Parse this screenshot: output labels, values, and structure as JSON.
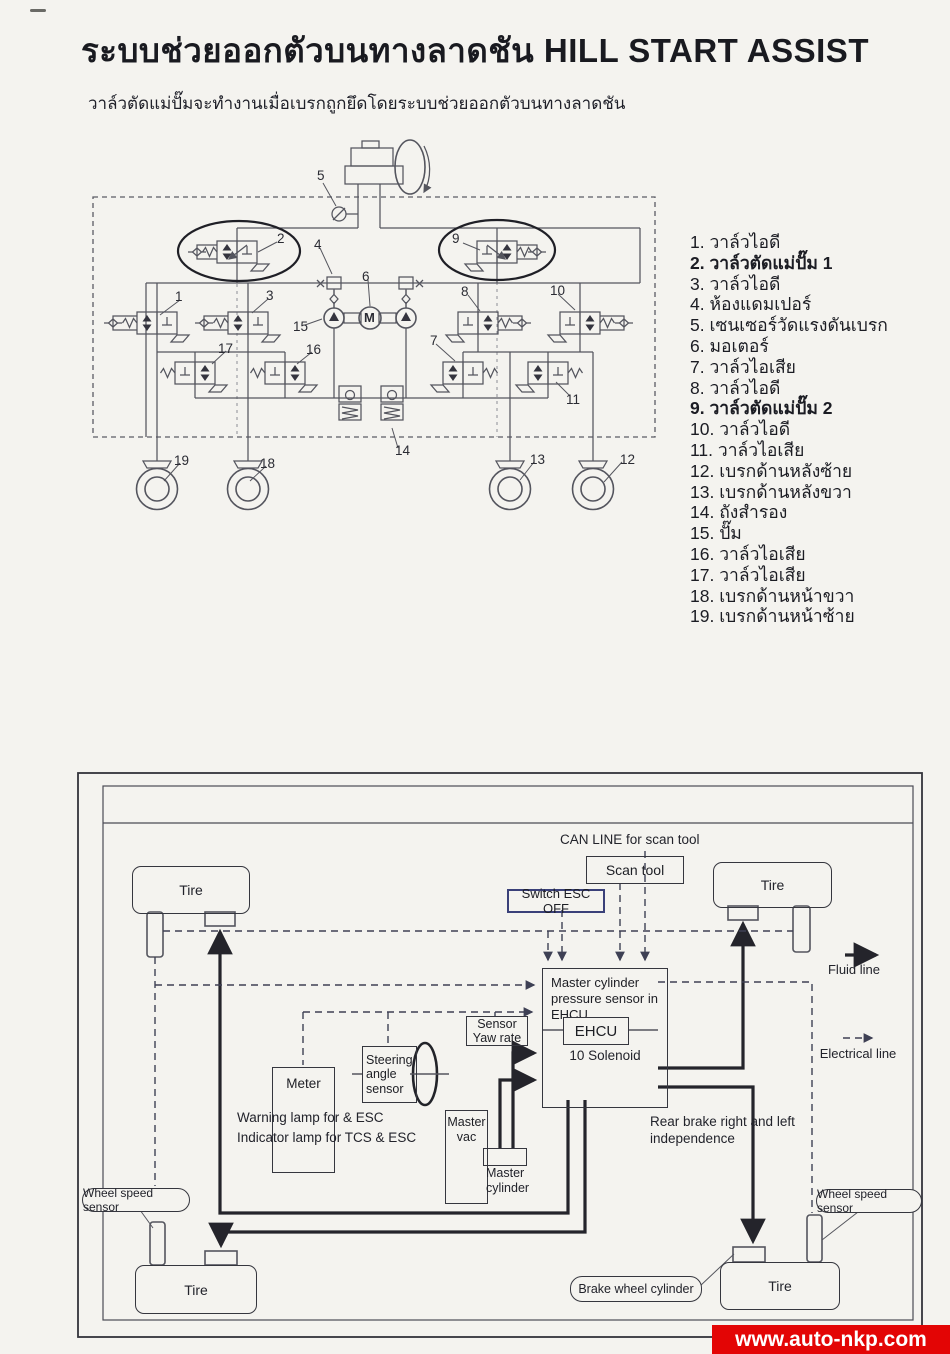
{
  "page": {
    "title": "ระบบช่วยออกตัวบนทางลาดชัน HILL START ASSIST",
    "subtitle": "วาล์วตัดแม่ปั๊มจะทำงานเมื่อเบรกถูกยึดโดยระบบช่วยออกตัวบนทางลาดชัน"
  },
  "legend": {
    "items": [
      "1. วาล์วไอดี",
      "2. วาล์วตัดแม่ปั๊ม 1",
      "3. วาล์วไอดี",
      "4. ห้องแดมเปอร์",
      "5. เซนเซอร์วัดแรงดันเบรก",
      "6. มอเตอร์",
      "7. วาล์วไอเสีย",
      "8. วาล์วไอดี",
      "9. วาล์วตัดแม่ปั๊ม 2",
      "10. วาล์วไอดี",
      "11. วาล์วไอเสีย",
      "12. เบรกด้านหลังซ้าย",
      "13. เบรกด้านหลังขวา",
      "14. ถังสำรอง",
      "15. ปั๊ม",
      "16. วาล์วไอเสีย",
      "17. วาล์วไอเสีย",
      "18. เบรกด้านหน้าขวา",
      "19. เบรกด้านหน้าซ้าย"
    ]
  },
  "top_diagram": {
    "motor_label": "M",
    "callouts": [
      "1",
      "2",
      "3",
      "4",
      "5",
      "6",
      "7",
      "8",
      "9",
      "10",
      "11",
      "12",
      "13",
      "14",
      "15",
      "16",
      "17",
      "18",
      "19"
    ]
  },
  "bottom_diagram": {
    "can_line_label": "CAN LINE for scan tool",
    "scan_tool": "Scan tool",
    "switch_esc_off": "Switch ESC OFF",
    "tire": "Tire",
    "ehcu_title": "Master cylinder pressure sensor in EHCU",
    "ehcu": "EHCU",
    "solenoid": "10 Solenoid",
    "sensor_yaw_rate": "Sensor Yaw rate",
    "steering_angle_sensor": "Steering angle sensor",
    "meter": "Meter",
    "warning_line1": "Warning lamp for & ESC",
    "warning_line2": "Indicator lamp for TCS & ESC",
    "master_vac": "Master vac",
    "master_cylinder": "Master cylinder",
    "rear_brake_note": "Rear brake right and left independence",
    "wheel_speed_sensor": "Wheel speed sensor",
    "brake_wheel_cylinder": "Brake wheel cylinder",
    "legend_fluid": "Fluid line",
    "legend_electrical": "Electrical line"
  },
  "watermark": "www.auto-nkp.com",
  "colors": {
    "watermark_bg": "#e30505",
    "paper": "#f4f3ef",
    "ink": "#1d1e24"
  }
}
